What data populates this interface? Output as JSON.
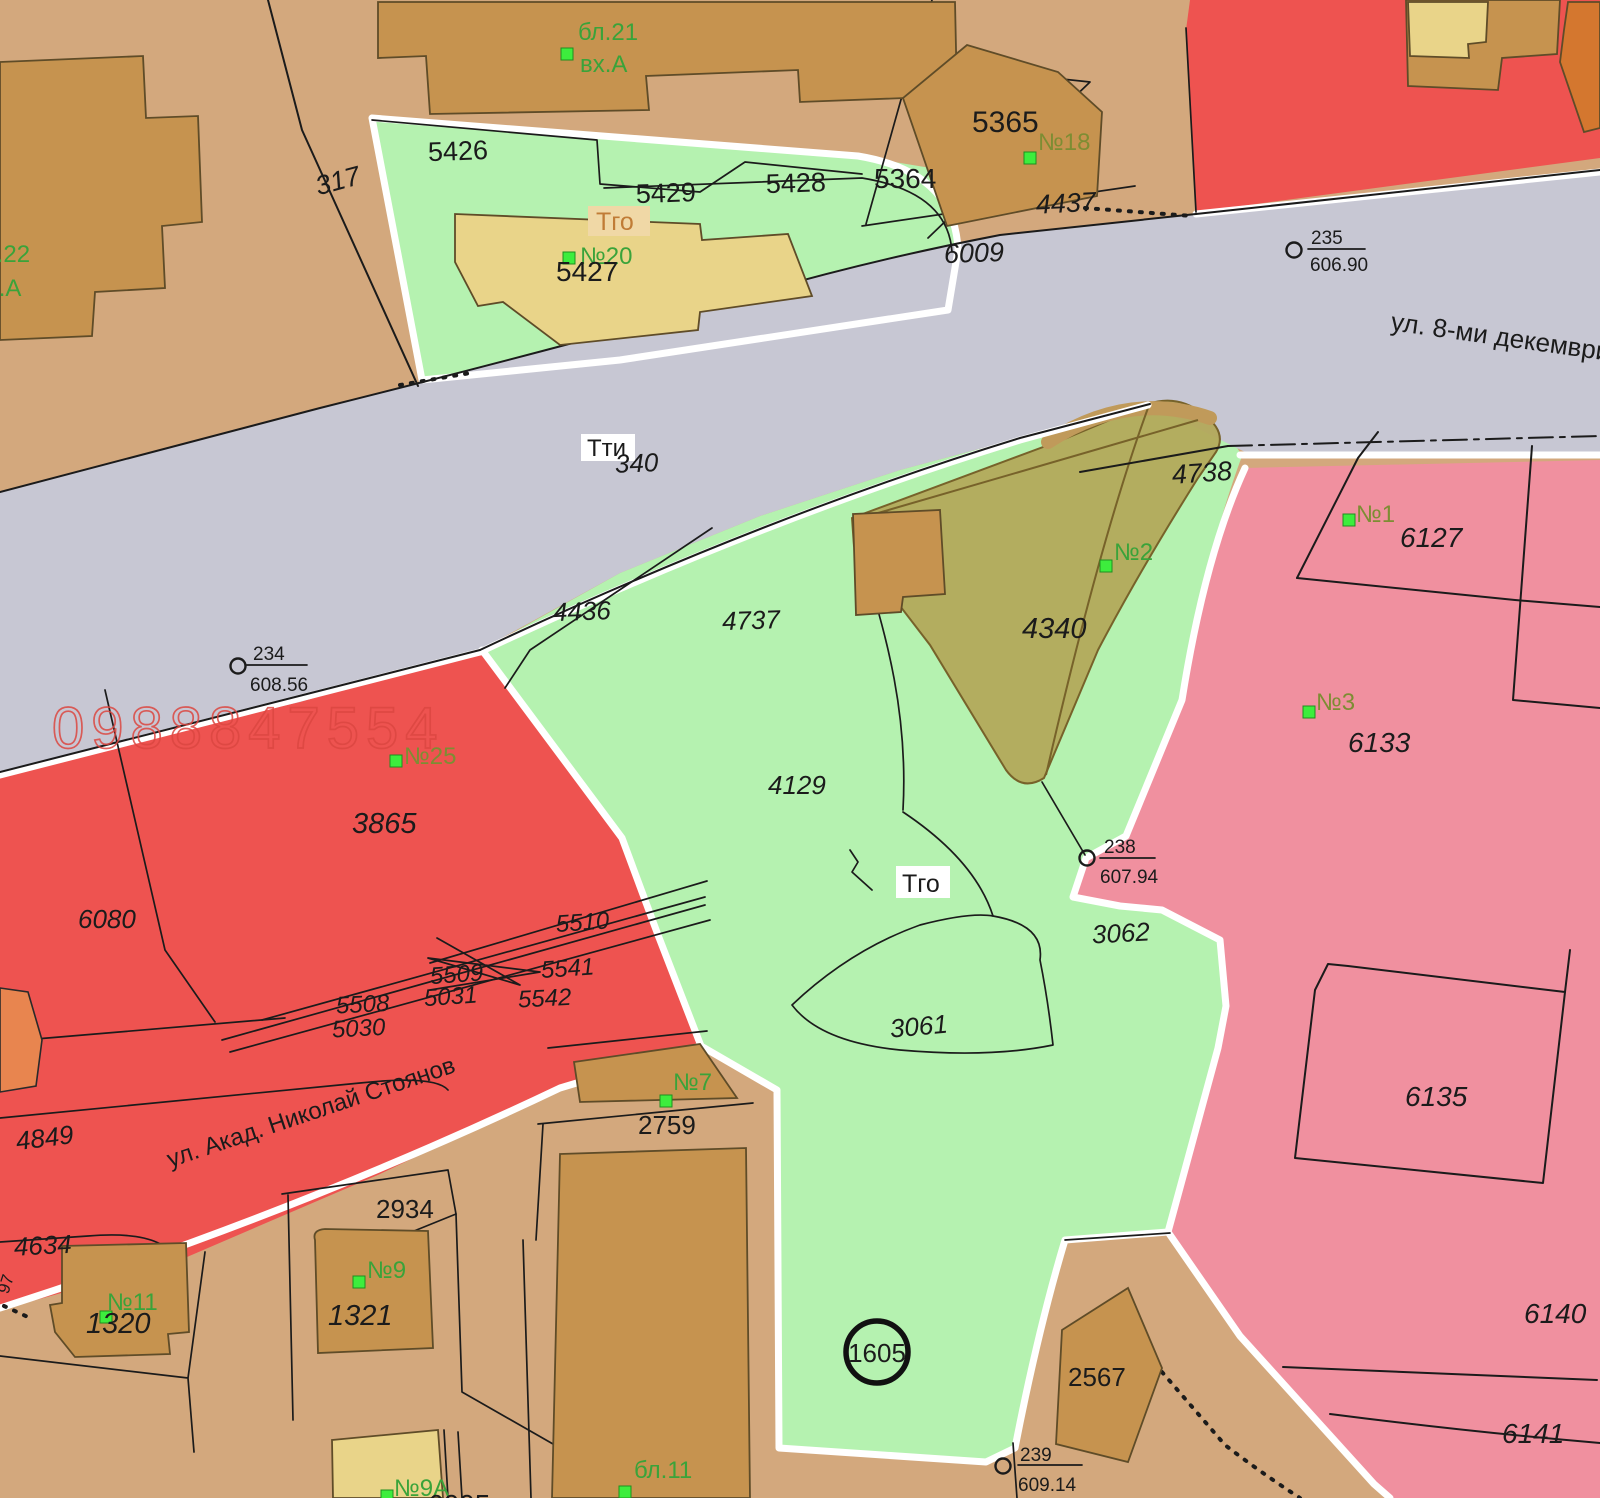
{
  "map": {
    "streets": {
      "dekemvri": "ул. 8-ми декември",
      "stoyanov": "ул. Акад. Николай Стоянов"
    },
    "labels": {
      "bl21": "бл.21",
      "bl21_entrance": "вх.А",
      "bl22": "бл.22",
      "bl22_entrance": "вх.А",
      "p317": "317",
      "p5426": "5426",
      "p5429": "5429",
      "p5428": "5428",
      "p5427": "5427",
      "tgo_top": "Тго",
      "n20": "№20",
      "p5365": "5365",
      "n18": "№18",
      "p5364": "5364",
      "p4437": "4437",
      "p6009": "6009",
      "tti": "Тти",
      "p340": "340",
      "p4436": "4436",
      "p4737": "4737",
      "p4738": "4738",
      "p4340": "4340",
      "n2": "№2",
      "p4129": "4129",
      "tgo_center": "Тго",
      "p3062": "3062",
      "p3061": "3061",
      "n1": "№1",
      "p6127": "6127",
      "n3": "№3",
      "p6133": "6133",
      "p6135": "6135",
      "p6140": "6140",
      "p6141": "6141",
      "watermark": "0988847554",
      "n25": "№25",
      "p3865": "3865",
      "p6080": "6080",
      "p5510": "5510",
      "p5509": "5509",
      "p5541": "5541",
      "p5508": "5508",
      "p5031": "5031",
      "p5542": "5542",
      "p5030": "5030",
      "p4849": "4849",
      "p4634": "4634",
      "edge_fragment": "97",
      "p2934": "2934",
      "n9": "№9",
      "p1321": "1321",
      "n11": "№11",
      "p1320": "1320",
      "n9a": "№9А",
      "p6005": "6005",
      "n7": "№7",
      "p2759": "2759",
      "bl11": "бл.11",
      "zone_1605": "1605",
      "p2567": "2567"
    },
    "survey_points": {
      "sp235": {
        "id": "235",
        "elevation": "606.90"
      },
      "sp234": {
        "id": "234",
        "elevation": "608.56"
      },
      "sp238": {
        "id": "238",
        "elevation": "607.94"
      },
      "sp239": {
        "id": "239",
        "elevation": "609.14"
      }
    },
    "colors": {
      "background_tan": "#d3a87d",
      "road_gray": "#c7c7d3",
      "zone_green": "#b5f2b0",
      "zone_red": "#ee5350",
      "zone_pink": "#f0909f",
      "zone_khaki": "#b3a95b",
      "building_tan": "#c6934f",
      "building_pale": "#e9d489",
      "orange_parcel": "#e8854f",
      "marker_green": "#3ded3d",
      "watermark_red": "#dc4741"
    }
  }
}
